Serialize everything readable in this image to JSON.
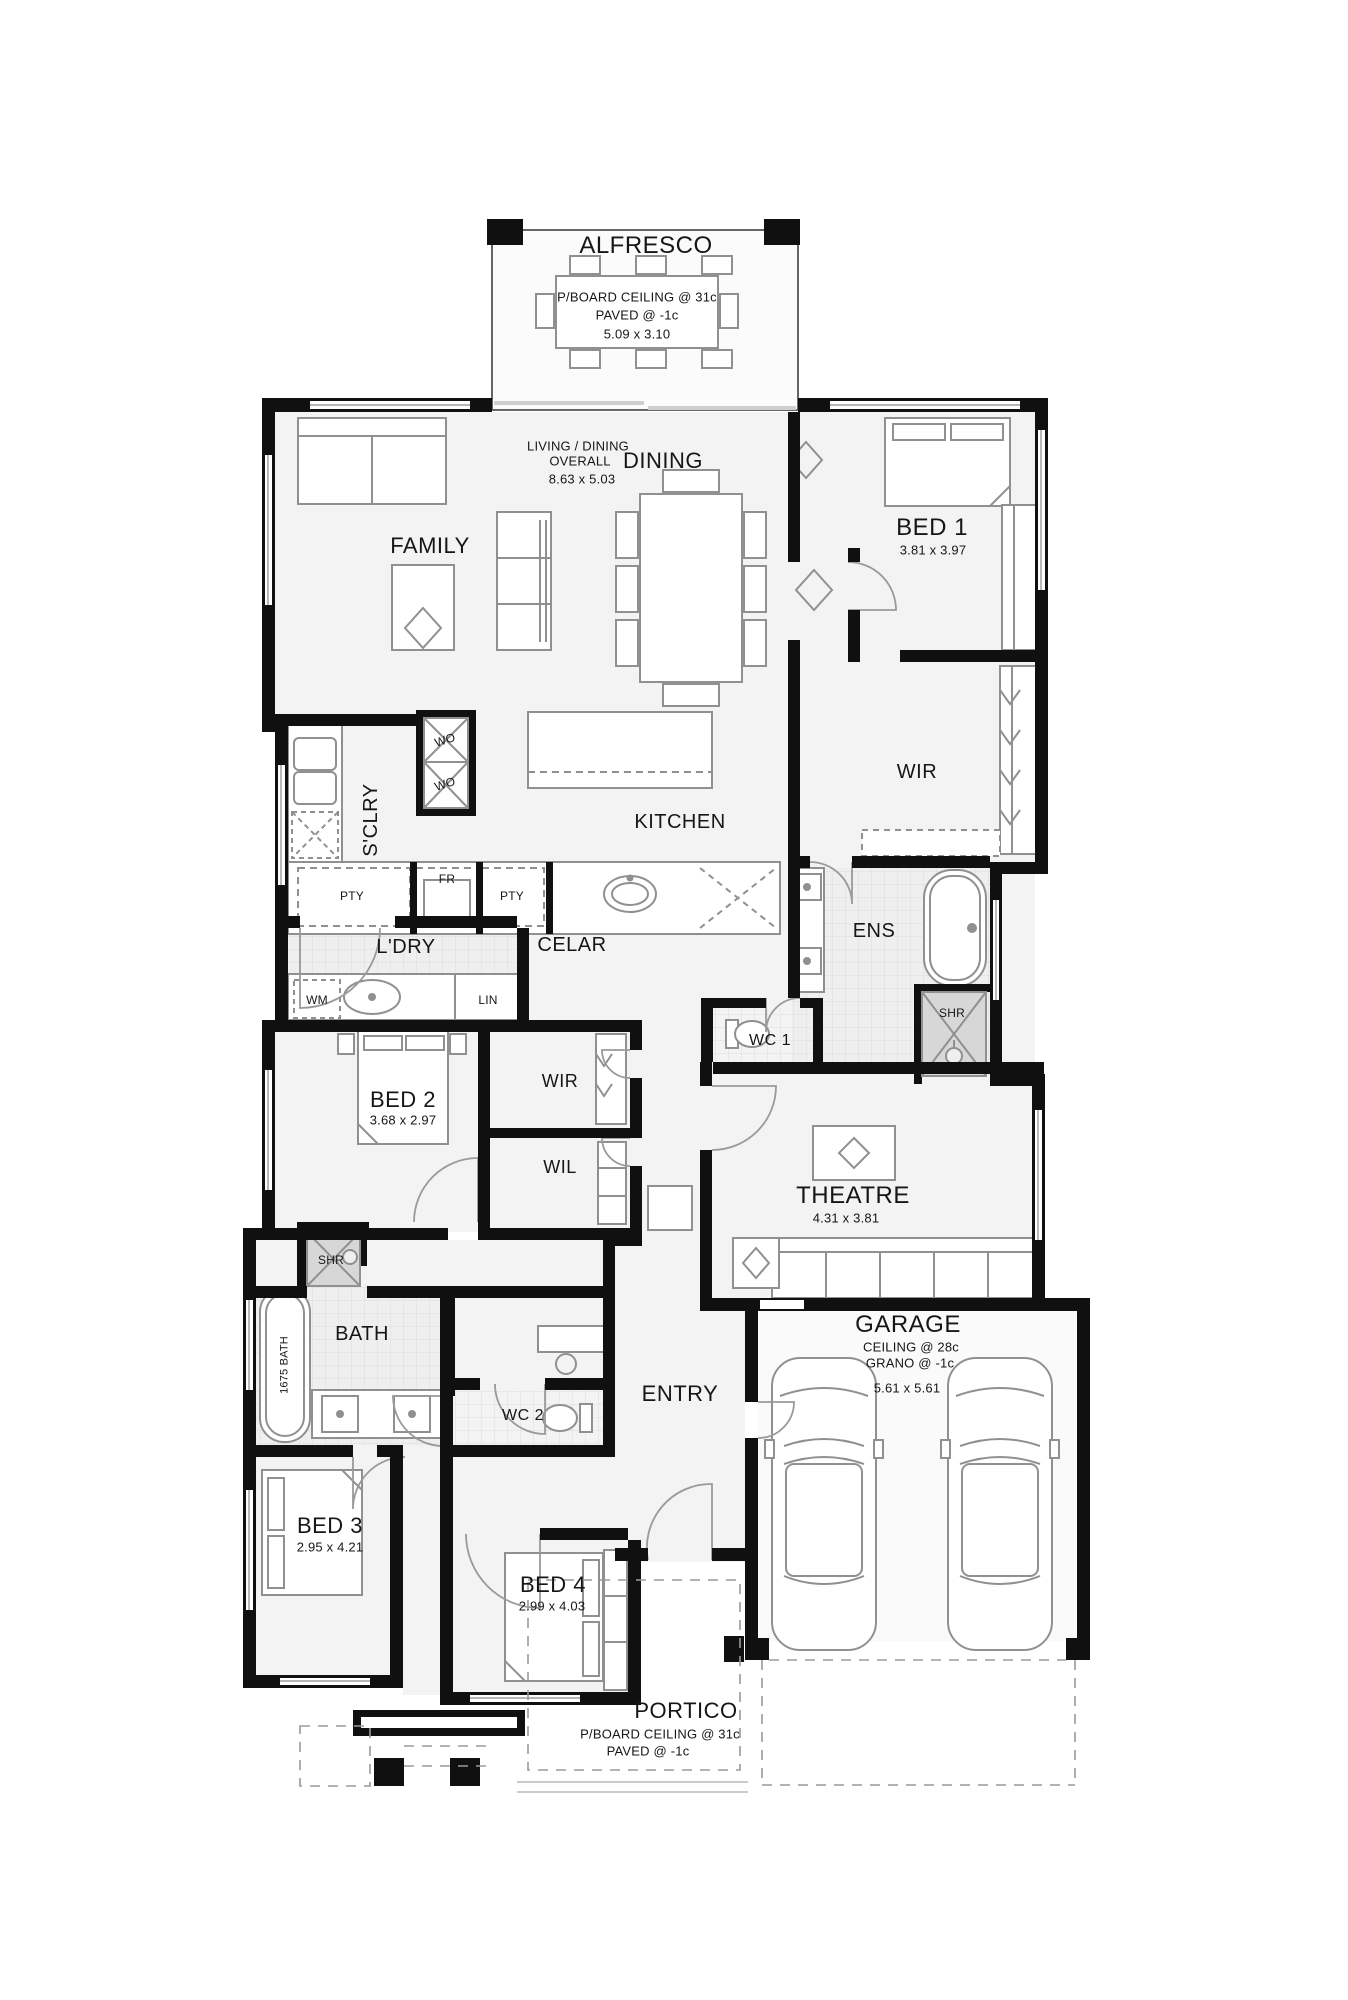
{
  "plan_colors": {
    "wall": "#101010",
    "floor": "#f3f3f3",
    "wet_floor": "#efefef",
    "shower_fill": "#d7d7d7",
    "fixture_line": "#909090",
    "text": "#161616"
  },
  "rooms": {
    "alfresco": {
      "name": "ALFRESCO",
      "ceiling": "P/BOARD CEILING @ 31c",
      "floor_note": "PAVED @ -1c",
      "size": "5.09 x 3.10"
    },
    "living_dining": {
      "line1": "LIVING / DINING",
      "line2": "OVERALL",
      "size": "8.63 x 5.03"
    },
    "dining": {
      "name": "DINING"
    },
    "family": {
      "name": "FAMILY"
    },
    "bed1": {
      "name": "BED 1",
      "size": "3.81 x 3.97"
    },
    "wir_main": {
      "name": "WIR"
    },
    "kitchen": {
      "name": "KITCHEN"
    },
    "scullery": {
      "name": "S'CLRY"
    },
    "laundry": {
      "name": "L'DRY"
    },
    "cellar": {
      "name": "CELAR"
    },
    "ens": {
      "name": "ENS"
    },
    "wc1": {
      "name": "WC 1"
    },
    "bed2": {
      "name": "BED 2",
      "size": "3.68 x 2.97"
    },
    "wir2": {
      "name": "WIR"
    },
    "wil": {
      "name": "WIL"
    },
    "theatre": {
      "name": "THEATRE",
      "size": "4.31 x 3.81"
    },
    "bath": {
      "name": "BATH",
      "tub": "1675 BATH"
    },
    "garage": {
      "name": "GARAGE",
      "ceiling": "CEILING @ 28c",
      "floor_note": "GRANO @ -1c",
      "size": "5.61 x 5.61"
    },
    "entry": {
      "name": "ENTRY"
    },
    "wc2": {
      "name": "WC 2"
    },
    "bed3": {
      "name": "BED 3",
      "size": "2.95 x 4.21"
    },
    "bed4": {
      "name": "BED 4",
      "size": "2.99 x 4.03"
    },
    "portico": {
      "name": "PORTICO",
      "ceiling": "P/BOARD CEILING @ 31c",
      "floor_note": "PAVED @ -1c"
    }
  },
  "fixtures": {
    "wall_oven": "WO",
    "pantry": "PTY",
    "fridge": "FR",
    "washing_machine": "WM",
    "linen": "LIN",
    "shower_ens": "SHR",
    "shower_bath": "SHR"
  }
}
